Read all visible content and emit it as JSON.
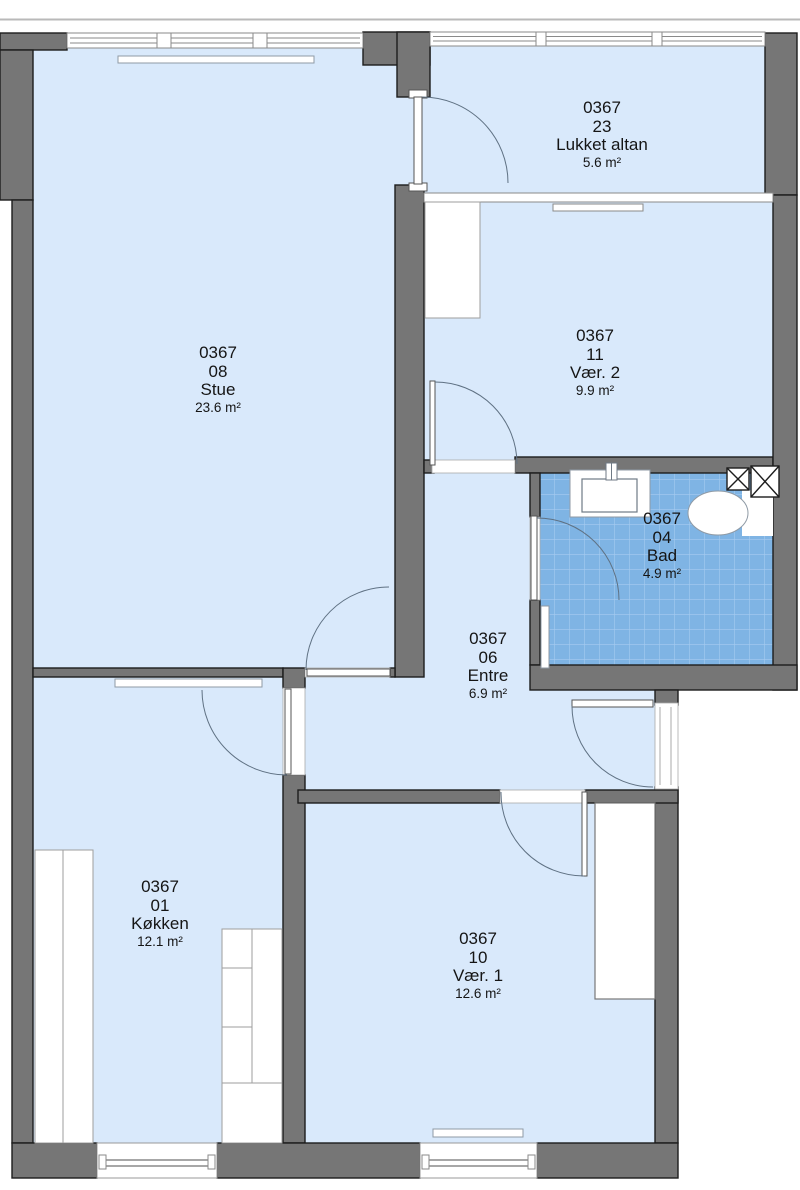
{
  "plan_name": "apartment-floor-plan",
  "colors": {
    "room_fill": "#d9e9fb",
    "tile_fill": "#7fb4e4",
    "tile_grid": "#a6cbf0",
    "wall_fill": "#767676",
    "wall_outline": "#1d1d1d",
    "fixture_outline": "#8f9aa5",
    "door_arc": "#5f7183"
  },
  "rooms": [
    {
      "id": "stue",
      "unit": "0367",
      "number": "08",
      "name": "Stue",
      "area": "23.6 m²"
    },
    {
      "id": "lukket-altan",
      "unit": "0367",
      "number": "23",
      "name": "Lukket altan",
      "area": "5.6 m²"
    },
    {
      "id": "vaer-2",
      "unit": "0367",
      "number": "11",
      "name": "Vær. 2",
      "area": "9.9 m²"
    },
    {
      "id": "bad",
      "unit": "0367",
      "number": "04",
      "name": "Bad",
      "area": "4.9 m²"
    },
    {
      "id": "entre",
      "unit": "0367",
      "number": "06",
      "name": "Entre",
      "area": "6.9 m²"
    },
    {
      "id": "koekken",
      "unit": "0367",
      "number": "01",
      "name": "Køkken",
      "area": "12.1 m²"
    },
    {
      "id": "vaer-1",
      "unit": "0367",
      "number": "10",
      "name": "Vær. 1",
      "area": "12.6 m²"
    }
  ]
}
